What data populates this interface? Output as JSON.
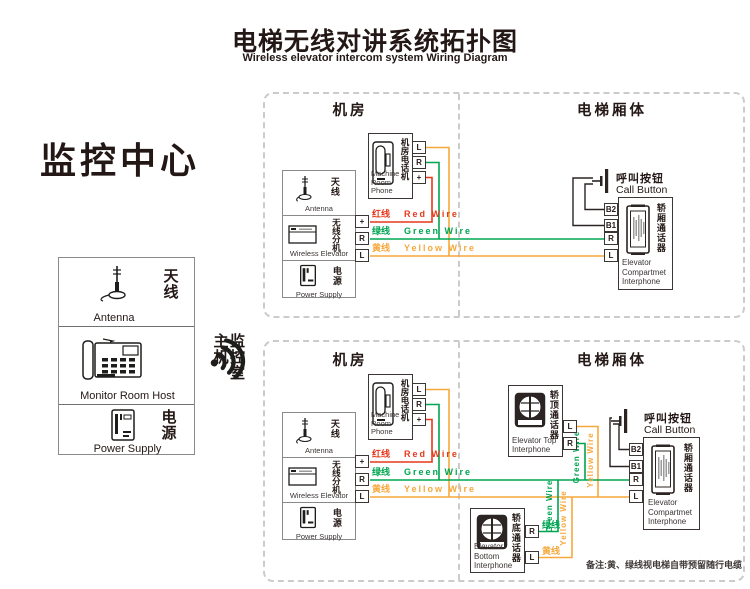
{
  "title": {
    "zh": "电梯无线对讲系统拓扑图",
    "en": "Wireless elevator intercom system Wiring Diagram"
  },
  "monitor_center": {
    "heading": "监控中心",
    "antenna": {
      "zh": "天线",
      "en": "Antenna"
    },
    "host": {
      "zh": "监控室主机",
      "en": "Monitor Room Host"
    },
    "power": {
      "zh": "电源",
      "en": "Power Supply"
    }
  },
  "section_headers": {
    "machine_room": "机房",
    "elevator_body": "电梯厢体"
  },
  "machine_phone": {
    "zh": "机房电话机",
    "en": "Machine\nRoom Phone"
  },
  "wireless_unit": {
    "antenna": {
      "zh": "天线",
      "en": "Antenna"
    },
    "extension": {
      "zh": "无线分机",
      "en": "Wireless Elevator"
    },
    "power": {
      "zh": "电源",
      "en": "Power Supply"
    }
  },
  "terminal_labels": {
    "plus": "+",
    "r": "R",
    "l": "L",
    "b1": "B1",
    "b2": "B2"
  },
  "wire_labels": {
    "red": {
      "zh": "红线",
      "en": "Red Wire",
      "color": "#e5391b"
    },
    "green": {
      "zh": "绿线",
      "en": "Green Wire",
      "color": "#00a551"
    },
    "yellow": {
      "zh": "黄线",
      "en": "Yellow Wire",
      "color": "#f6a83c"
    }
  },
  "call_button": {
    "zh": "呼叫按钮",
    "en": "Call Button"
  },
  "compartment_interphone": {
    "zh": "轿厢通话器",
    "en": "Elevator\nCompartmet\nInterphone"
  },
  "top_interphone": {
    "zh": "轿顶通话器",
    "en": "Elevator Top\nInterphone"
  },
  "bottom_interphone": {
    "zh": "轿底通话器",
    "en": "Elevator Bottom\nInterphone"
  },
  "note": "备注:黄、绿线视电梯自带预留随行电缆"
}
